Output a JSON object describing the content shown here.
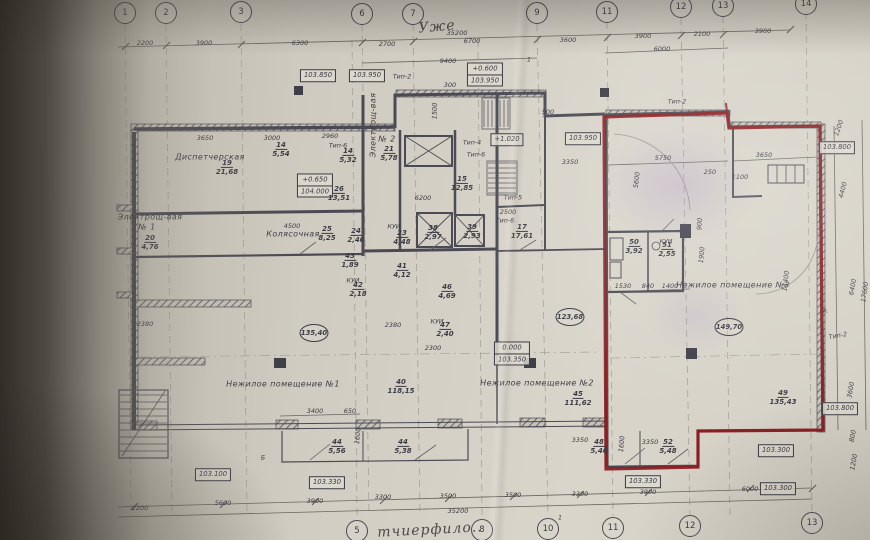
{
  "plan": {
    "grid_top": [
      {
        "n": "1",
        "x": 125,
        "y": 13
      },
      {
        "n": "2",
        "x": 166,
        "y": 13
      },
      {
        "n": "3",
        "x": 241,
        "y": 12
      },
      {
        "n": "6",
        "x": 362,
        "y": 14
      },
      {
        "n": "7",
        "x": 413,
        "y": 14
      },
      {
        "n": "9",
        "x": 537,
        "y": 13
      },
      {
        "n": "11",
        "x": 607,
        "y": 12
      },
      {
        "n": "12",
        "x": 681,
        "y": 7
      },
      {
        "n": "13",
        "x": 723,
        "y": 6
      },
      {
        "n": "14",
        "x": 806,
        "y": 4
      }
    ],
    "grid_bottom": [
      {
        "n": "5",
        "x": 357,
        "y": 531
      },
      {
        "n": "8",
        "x": 482,
        "y": 530
      },
      {
        "n": "10",
        "x": 548,
        "y": 529
      },
      {
        "n": "11",
        "x": 613,
        "y": 528
      },
      {
        "n": "12",
        "x": 690,
        "y": 526
      },
      {
        "n": "13",
        "x": 812,
        "y": 523
      }
    ],
    "dims": [
      {
        "t": "2200",
        "x": 145,
        "y": 43
      },
      {
        "t": "3900",
        "x": 204,
        "y": 43
      },
      {
        "t": "6300",
        "x": 300,
        "y": 43
      },
      {
        "t": "2700",
        "x": 387,
        "y": 44
      },
      {
        "t": "6700",
        "x": 472,
        "y": 41
      },
      {
        "t": "3600",
        "x": 568,
        "y": 40
      },
      {
        "t": "3900",
        "x": 643,
        "y": 36
      },
      {
        "t": "2100",
        "x": 702,
        "y": 34
      },
      {
        "t": "3900",
        "x": 763,
        "y": 31
      },
      {
        "t": "35200",
        "x": 457,
        "y": 33
      },
      {
        "t": "9400",
        "x": 448,
        "y": 61
      },
      {
        "t": "6000",
        "x": 662,
        "y": 49
      },
      {
        "t": "300",
        "x": 450,
        "y": 85
      },
      {
        "t": "3650",
        "x": 205,
        "y": 138
      },
      {
        "t": "3000",
        "x": 272,
        "y": 138
      },
      {
        "t": "2960",
        "x": 330,
        "y": 136
      },
      {
        "t": "6200",
        "x": 423,
        "y": 198
      },
      {
        "t": "2500",
        "x": 508,
        "y": 212
      },
      {
        "t": "3350",
        "x": 570,
        "y": 162
      },
      {
        "t": "500",
        "x": 548,
        "y": 112
      },
      {
        "t": "1500",
        "x": 435,
        "y": 111,
        "rot": -88
      },
      {
        "t": "2380",
        "x": 145,
        "y": 324
      },
      {
        "t": "2380",
        "x": 393,
        "y": 325
      },
      {
        "t": "2300",
        "x": 433,
        "y": 348
      },
      {
        "t": "4500",
        "x": 292,
        "y": 226
      },
      {
        "t": "5750",
        "x": 663,
        "y": 158
      },
      {
        "t": "5600",
        "x": 637,
        "y": 180,
        "rot": -83
      },
      {
        "t": "250",
        "x": 710,
        "y": 172
      },
      {
        "t": "1100",
        "x": 740,
        "y": 177
      },
      {
        "t": "3650",
        "x": 764,
        "y": 155
      },
      {
        "t": "1530",
        "x": 623,
        "y": 286
      },
      {
        "t": "840",
        "x": 648,
        "y": 286
      },
      {
        "t": "1400",
        "x": 670,
        "y": 286
      },
      {
        "t": "1900",
        "x": 702,
        "y": 255,
        "rot": -85
      },
      {
        "t": "900",
        "x": 700,
        "y": 224,
        "rot": -85
      },
      {
        "t": "14400",
        "x": 786,
        "y": 281,
        "rot": -83
      },
      {
        "t": "1200",
        "x": 839,
        "y": 128,
        "rot": -70
      },
      {
        "t": "4400",
        "x": 843,
        "y": 190,
        "rot": -76
      },
      {
        "t": "6400",
        "x": 853,
        "y": 287,
        "rot": -80
      },
      {
        "t": "17600",
        "x": 865,
        "y": 292,
        "rot": -82
      },
      {
        "t": "3600",
        "x": 851,
        "y": 390,
        "rot": -80
      },
      {
        "t": "800",
        "x": 853,
        "y": 436,
        "rot": -80
      },
      {
        "t": "1200",
        "x": 854,
        "y": 462,
        "rot": -80
      },
      {
        "t": "2200",
        "x": 140,
        "y": 508
      },
      {
        "t": "5600",
        "x": 223,
        "y": 503
      },
      {
        "t": "3900",
        "x": 315,
        "y": 501
      },
      {
        "t": "3300",
        "x": 383,
        "y": 497
      },
      {
        "t": "3500",
        "x": 448,
        "y": 496
      },
      {
        "t": "3500",
        "x": 513,
        "y": 495
      },
      {
        "t": "3300",
        "x": 580,
        "y": 494
      },
      {
        "t": "3900",
        "x": 648,
        "y": 492
      },
      {
        "t": "6000",
        "x": 750,
        "y": 489
      },
      {
        "t": "35200",
        "x": 458,
        "y": 511
      },
      {
        "t": "3400",
        "x": 315,
        "y": 411
      },
      {
        "t": "650",
        "x": 350,
        "y": 411
      },
      {
        "t": "3350",
        "x": 580,
        "y": 440
      },
      {
        "t": "3350",
        "x": 650,
        "y": 442
      },
      {
        "t": "1600",
        "x": 622,
        "y": 444,
        "rot": -85
      },
      {
        "t": "1600",
        "x": 358,
        "y": 436,
        "rot": -85
      }
    ],
    "elevations": [
      {
        "rows": [
          "103.850"
        ],
        "x": 318,
        "y": 76
      },
      {
        "rows": [
          "103.950"
        ],
        "x": 367,
        "y": 76
      },
      {
        "rows": [
          "+0.600",
          "103.950"
        ],
        "x": 485,
        "y": 75
      },
      {
        "rows": [
          "103.950"
        ],
        "x": 583,
        "y": 139
      },
      {
        "rows": [
          "+0.650",
          "104.000"
        ],
        "x": 315,
        "y": 186
      },
      {
        "rows": [
          "+1.020"
        ],
        "x": 507,
        "y": 140
      },
      {
        "rows": [
          "0.000",
          "103.350"
        ],
        "x": 512,
        "y": 354
      },
      {
        "rows": [
          "103.800"
        ],
        "x": 837,
        "y": 148
      },
      {
        "rows": [
          "103.800"
        ],
        "x": 840,
        "y": 409
      },
      {
        "rows": [
          "103.100"
        ],
        "x": 213,
        "y": 475
      },
      {
        "rows": [
          "103.330"
        ],
        "x": 327,
        "y": 483
      },
      {
        "rows": [
          "103.330"
        ],
        "x": 643,
        "y": 482
      },
      {
        "rows": [
          "103.300"
        ],
        "x": 776,
        "y": 451
      },
      {
        "rows": [
          "103.300"
        ],
        "x": 778,
        "y": 489
      }
    ],
    "rooms": [
      {
        "num": "19",
        "area": "21,68",
        "x": 227,
        "y": 168
      },
      {
        "num": "20",
        "area": "4,76",
        "x": 150,
        "y": 243
      },
      {
        "num": "14",
        "area": "5,54",
        "x": 281,
        "y": 150
      },
      {
        "num": "14",
        "area": "5,32",
        "x": 348,
        "y": 156
      },
      {
        "num": "21",
        "area": "5,78",
        "x": 389,
        "y": 154
      },
      {
        "num": "26",
        "area": "13,51",
        "x": 339,
        "y": 194
      },
      {
        "num": "25",
        "area": "8,25",
        "x": 327,
        "y": 234
      },
      {
        "num": "24",
        "area": "2,40",
        "x": 356,
        "y": 236
      },
      {
        "num": "23",
        "area": "4,48",
        "x": 402,
        "y": 238
      },
      {
        "num": "15",
        "area": "12,85",
        "x": 462,
        "y": 184
      },
      {
        "num": "38",
        "area": "2,97",
        "x": 433,
        "y": 233
      },
      {
        "num": "39",
        "area": "2,93",
        "x": 472,
        "y": 232
      },
      {
        "num": "41",
        "area": "4,12",
        "x": 402,
        "y": 271
      },
      {
        "num": "43",
        "area": "1,89",
        "x": 350,
        "y": 261
      },
      {
        "num": "42",
        "area": "2,18",
        "x": 358,
        "y": 290
      },
      {
        "num": "46",
        "area": "4,69",
        "x": 447,
        "y": 292
      },
      {
        "num": "47",
        "area": "2,40",
        "x": 445,
        "y": 330
      },
      {
        "num": "17",
        "area": "17,61",
        "x": 522,
        "y": 232
      },
      {
        "num": "44",
        "area": "5,56",
        "x": 337,
        "y": 447
      },
      {
        "num": "44",
        "area": "5,38",
        "x": 403,
        "y": 447
      },
      {
        "num": "48",
        "area": "5,46",
        "x": 599,
        "y": 447
      },
      {
        "num": "52",
        "area": "5,48",
        "x": 668,
        "y": 447
      },
      {
        "num": "40",
        "area": "118,15",
        "x": 401,
        "y": 387
      },
      {
        "num": "45",
        "area": "111,62",
        "x": 578,
        "y": 399
      },
      {
        "num": "49",
        "area": "135,43",
        "x": 783,
        "y": 398
      },
      {
        "num": "50",
        "area": "3,92",
        "x": 634,
        "y": 247
      },
      {
        "num": "51",
        "area": "2,55",
        "x": 667,
        "y": 250
      }
    ],
    "room_names": [
      {
        "t": "Диспетчерская",
        "x": 210,
        "y": 157
      },
      {
        "t": "Колясочная",
        "x": 293,
        "y": 234
      },
      {
        "t": "Нежилое помещение №1",
        "x": 283,
        "y": 384
      },
      {
        "t": "Нежилое помещение №2",
        "x": 537,
        "y": 383
      },
      {
        "t": "Нежилое помещение №3",
        "x": 733,
        "y": 285
      },
      {
        "t": "Электрощ-вая",
        "x": 150,
        "y": 217
      },
      {
        "t": "№ 1",
        "x": 147,
        "y": 227
      },
      {
        "t": "Электрощ-вая",
        "x": 373,
        "y": 125,
        "rot": -90
      },
      {
        "t": "№ 2",
        "x": 387,
        "y": 139
      }
    ],
    "area_circles": [
      {
        "t": "135,40",
        "x": 314,
        "y": 333
      },
      {
        "t": "123,68",
        "x": 570,
        "y": 317
      },
      {
        "t": "149,70",
        "x": 729,
        "y": 327
      }
    ],
    "type_labels": [
      {
        "t": "Тип-2",
        "x": 402,
        "y": 77
      },
      {
        "t": "Тип-6",
        "x": 338,
        "y": 146
      },
      {
        "t": "Тип-4",
        "x": 472,
        "y": 143
      },
      {
        "t": "Тип-6",
        "x": 476,
        "y": 155
      },
      {
        "t": "Тип-5",
        "x": 513,
        "y": 198
      },
      {
        "t": "Тип-6",
        "x": 505,
        "y": 221
      },
      {
        "t": "Тип-2",
        "x": 677,
        "y": 102
      },
      {
        "t": "Тип-2",
        "x": 838,
        "y": 336,
        "rot": -10
      }
    ],
    "small_labels": [
      {
        "t": "КУИ",
        "x": 394,
        "y": 227
      },
      {
        "t": "КУИ",
        "x": 353,
        "y": 281
      },
      {
        "t": "КУИ",
        "x": 437,
        "y": 322
      },
      {
        "t": "КУИ",
        "x": 666,
        "y": 242
      },
      {
        "t": "Б",
        "x": 263,
        "y": 458
      },
      {
        "t": "1",
        "x": 529,
        "y": 60
      },
      {
        "t": "1",
        "x": 560,
        "y": 518
      },
      {
        "t": "к.",
        "x": 826,
        "y": 311
      }
    ],
    "handwriting": [
      {
        "t": "Уже",
        "x": 437,
        "y": 27,
        "rot": -5
      },
      {
        "t": "тчиерфило..",
        "x": 430,
        "y": 530,
        "rot": -3
      }
    ],
    "colors": {
      "paper": "#d6d2c8",
      "line": "#4b4a54",
      "red_outline": "#8e1b1f",
      "shadow": "#2f2a24"
    }
  }
}
